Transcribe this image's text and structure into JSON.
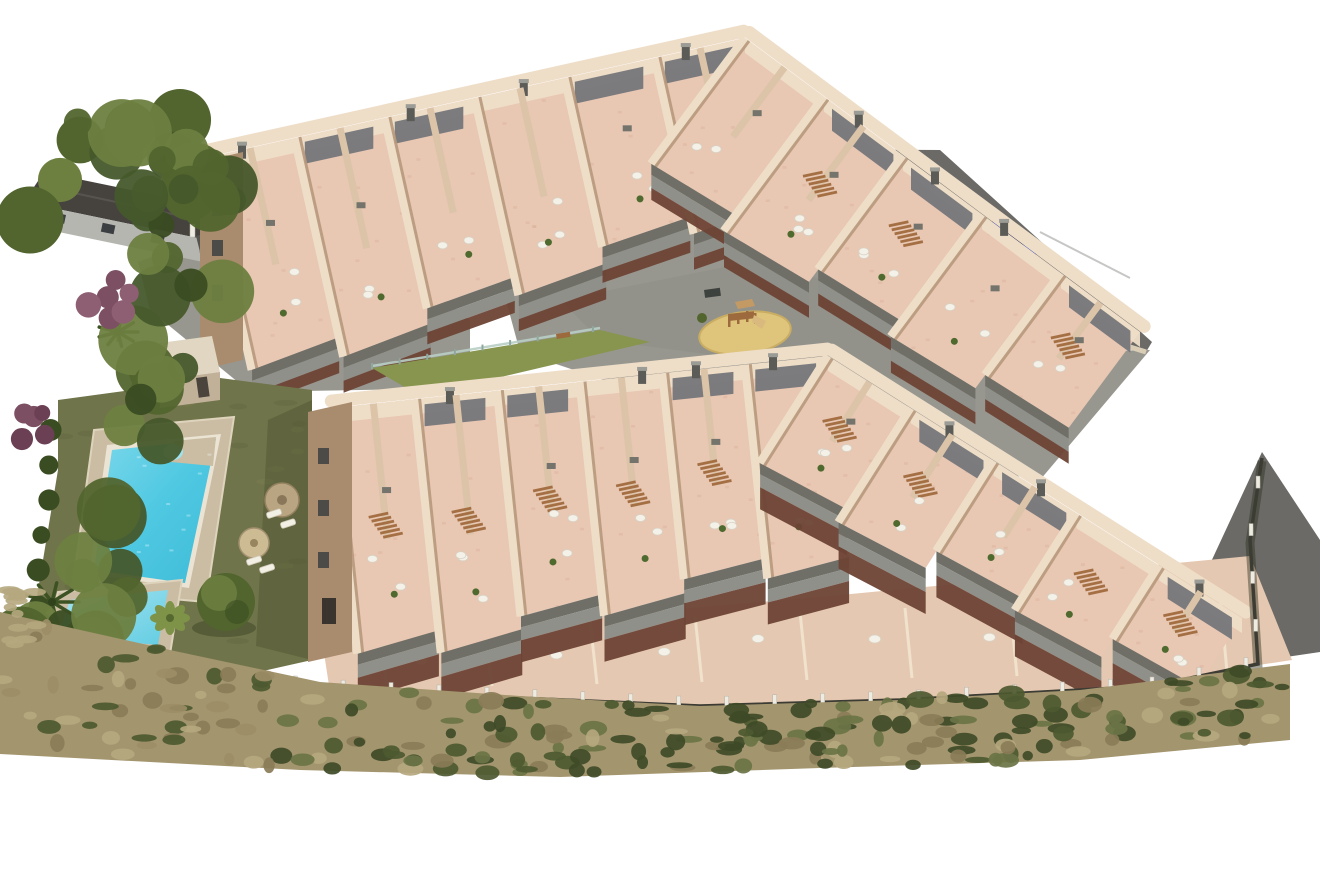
{
  "scene": {
    "type": "aerial-architectural-render",
    "description": "Aerial 3D render of a hillside residential complex: two bent rows of stepped terraced apartments with pink roof terraces and grey curved balconies, a communal garden with two swimming pools, a central playground, access roads, perimeter fencing and surrounding vegetation",
    "features": {
      "building_rows": 2,
      "roof_terraces": true,
      "pools": [
        {
          "name": "main-pool"
        },
        {
          "name": "kids-pool"
        }
      ],
      "parasols": 2,
      "sun_loungers": 4,
      "playground": {
        "equipment": "wooden-climber-with-slide",
        "surface": "sand-circle"
      },
      "parked_cars": [
        {
          "color_hex": "#2940a8"
        }
      ],
      "perimeter_fence_posts": true,
      "vegetation": [
        "left-tree-band",
        "purple-flowering-shrubs",
        "palm-trees",
        "round-bush",
        "bottom-scrubland"
      ]
    },
    "palette": {
      "background": "#ffffff",
      "road": "#6b6a67",
      "paving": "#98978f",
      "paving_dark": "#8a8981",
      "neighbor_roof": "#46433f",
      "neighbor_wall": "#b6b6b0",
      "window_dark": "#3c3f42",
      "wall_light": "#eedec8",
      "wall_mid": "#dcc4a8",
      "wall_shadow": "#b8997c",
      "facade_shadow": "#a98b6d",
      "terrace_pink": "#e8c7b3",
      "terrace_speckle": "#d9ae97",
      "under_balcony": "#6d4335",
      "balcony_top": "#6f6f67",
      "balcony_face": "#90908a",
      "roof_panel": "#75767a",
      "chimney": "#5b5b57",
      "chimney_cap": "#9c9c96",
      "stair_wood": "#a56f44",
      "furniture_white": "#f4f1e9",
      "furniture_gray": "#74746c",
      "plant_green": "#4e6a2e",
      "lawn": "#70744a",
      "lawn_bright": "#87954e",
      "lawn_shadow": "#4e5433",
      "sand": "#dfc47c",
      "sand_edge": "#c9ad62",
      "play_wood": "#9c6a3c",
      "play_wood_light": "#c49a64",
      "pool_deck": "#cbbda3",
      "pool_coping": "#ebe4d4",
      "pool_water": "#4fc8e2",
      "pool_water_deep": "#3fbcd8",
      "pool_water_light": "#b9edf6",
      "parasol_tan": "#b9a582",
      "parasol_tan2": "#cdbb94",
      "lounger": "#f2efe5",
      "bush_dark": "#3a4c22",
      "bush_mid": "#52652e",
      "bush_light": "#6d8040",
      "palm_dark": "#3c5222",
      "purple_shrub": "#7c4f63",
      "purple_shrub2": "#8e5f72",
      "scrub_base": "#a3956e",
      "scrub_tan": "#b5a77e",
      "scrub_tan2": "#8a7c57",
      "scrub_green_dark": "#3f4b27",
      "scrub_green": "#4d5930",
      "scrub_olive": "#6a7445",
      "fence_line": "#3c3c34",
      "fence_post": "#edebe2",
      "glass_fence": "#b9cfc6",
      "car_body": "#2940a8",
      "car_glass": "#131c46"
    }
  }
}
